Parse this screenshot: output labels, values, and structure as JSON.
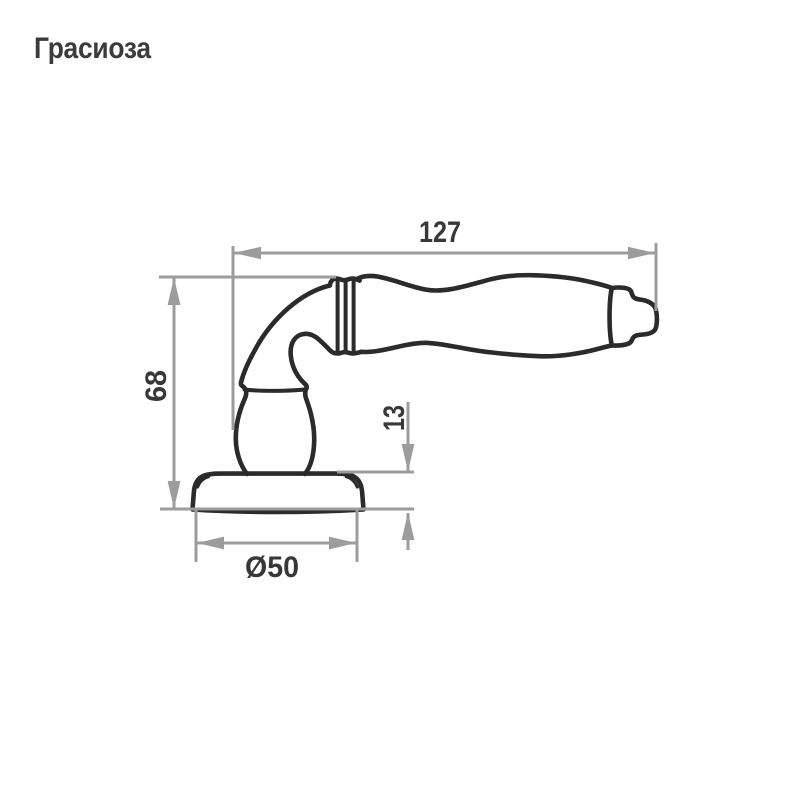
{
  "page": {
    "background_color": "#ffffff",
    "product_title": "Грасиоза"
  },
  "drawing": {
    "subject": "door-lever-handle-side-view",
    "dimensions": {
      "length": "127",
      "height": "68",
      "base_thickness": "13",
      "base_diameter": "Ø50"
    },
    "colors": {
      "outline": "#2b2b2b",
      "dimension_line": "#9c9c9c",
      "text": "#3b3b3b"
    }
  }
}
